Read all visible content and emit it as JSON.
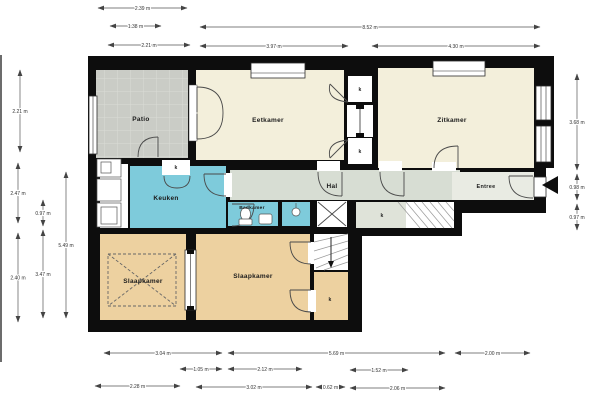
{
  "title": "floor-plan",
  "plan": {
    "colors": {
      "wall": "#0d0d0d",
      "living_cream": "#f3efdb",
      "kitchen_bath_teal": "#7ecbdb",
      "hall_gray": "#d7ddd3",
      "entree_gray": "#e9ebe3",
      "closet_gray": "#dfe3d9",
      "bedroom_tan": "#edd1a0",
      "patio_gray": "#caccc6",
      "dim_line": "#555555",
      "dim_text": "#333333"
    },
    "rooms": [
      {
        "id": "patio",
        "label": "Patio",
        "x": 96,
        "y": 70,
        "w": 92,
        "h": 88,
        "fill": "#caccc6",
        "pattern": "tiles",
        "lx": 141,
        "ly": 121,
        "fs": 6.5
      },
      {
        "id": "eetkamer",
        "label": "Eetkamer",
        "x": 196,
        "y": 70,
        "w": 148,
        "h": 90,
        "fill": "#f3efdb",
        "lx": 268,
        "ly": 122,
        "fs": 6.5
      },
      {
        "id": "zitkamer",
        "label": "Zitkamer",
        "x": 378,
        "y": 68,
        "w": 156,
        "h": 100,
        "fill": "#f3efdb",
        "lx": 452,
        "ly": 122,
        "fs": 6.5
      },
      {
        "id": "counter",
        "label": "",
        "x": 100,
        "y": 164,
        "w": 28,
        "h": 64,
        "fill": "#ffffff"
      },
      {
        "id": "keuken",
        "label": "Keuken",
        "x": 130,
        "y": 166,
        "w": 96,
        "h": 62,
        "fill": "#7ecbdb",
        "lx": 166,
        "ly": 200,
        "fs": 6.5
      },
      {
        "id": "hal",
        "label": "Hal",
        "x": 230,
        "y": 170,
        "w": 230,
        "h": 30,
        "fill": "#d7ddd3",
        "lx": 332,
        "ly": 188,
        "fs": 6.5
      },
      {
        "id": "badkamer",
        "label": "Badkamer",
        "x": 228,
        "y": 202,
        "w": 50,
        "h": 24,
        "fill": "#7ecbdb",
        "lx": 252,
        "ly": 209,
        "fs": 4.8
      },
      {
        "id": "douche",
        "label": "",
        "x": 282,
        "y": 202,
        "w": 28,
        "h": 24,
        "fill": "#7ecbdb"
      },
      {
        "id": "entree",
        "label": "Entree",
        "x": 452,
        "y": 172,
        "w": 82,
        "h": 28,
        "fill": "#e9ebe3",
        "lx": 486,
        "ly": 188,
        "fs": 5.5
      },
      {
        "id": "kastruimte",
        "label": "k",
        "x": 356,
        "y": 202,
        "w": 98,
        "h": 26,
        "fill": "#dfe3d9",
        "lx": 382,
        "ly": 217,
        "fs": 5
      },
      {
        "id": "slaapkamer-1",
        "label": "Slaapkamer",
        "x": 100,
        "y": 234,
        "w": 86,
        "h": 86,
        "fill": "#edd1a0",
        "lx": 143,
        "ly": 283,
        "fs": 6.5
      },
      {
        "id": "slaapkamer-2",
        "label": "Slaapkamer",
        "x": 196,
        "y": 234,
        "w": 114,
        "h": 86,
        "fill": "#edd1a0",
        "lx": 253,
        "ly": 278,
        "fs": 6.5
      },
      {
        "id": "trap",
        "label": "",
        "x": 314,
        "y": 234,
        "w": 34,
        "h": 36,
        "fill": "#ffffff"
      },
      {
        "id": "kast-onder",
        "label": "k",
        "x": 314,
        "y": 272,
        "w": 34,
        "h": 48,
        "fill": "#edd1a0",
        "lx": 330,
        "ly": 301,
        "fs": 5
      },
      {
        "id": "kast-boven-1",
        "label": "k",
        "x": 348,
        "y": 76,
        "w": 24,
        "h": 26,
        "fill": "#ffffff",
        "lx": 360,
        "ly": 91,
        "fs": 5
      },
      {
        "id": "kast-boven-2",
        "label": "k",
        "x": 348,
        "y": 138,
        "w": 24,
        "h": 26,
        "fill": "#ffffff",
        "lx": 360,
        "ly": 153,
        "fs": 5
      },
      {
        "id": "keuken-kast",
        "label": "k",
        "x": 162,
        "y": 160,
        "w": 28,
        "h": 15,
        "fill": "#ffffff",
        "lx": 176,
        "ly": 169,
        "fs": 5
      }
    ],
    "dimensions": {
      "top": [
        {
          "x1": 98,
          "x2": 187,
          "y": 8,
          "label": "2.39 m"
        },
        {
          "x1": 110,
          "x2": 161,
          "y": 26,
          "label": "1.38 m"
        },
        {
          "x1": 200,
          "x2": 540,
          "y": 27,
          "label": "8.52 m"
        },
        {
          "x1": 108,
          "x2": 190,
          "y": 45,
          "label": "2.21 m"
        },
        {
          "x1": 200,
          "x2": 348,
          "y": 46,
          "label": "3.97 m"
        },
        {
          "x1": 372,
          "x2": 540,
          "y": 46,
          "label": "4.30 m"
        }
      ],
      "left": [
        {
          "x": 20,
          "y1": 70,
          "y2": 152,
          "label": "2.21 m"
        },
        {
          "x": 18,
          "y1": 163,
          "y2": 223,
          "label": "2.47 m"
        },
        {
          "x": 18,
          "y1": 233,
          "y2": 322,
          "label": "2.40 m"
        },
        {
          "x": 43,
          "y1": 200,
          "y2": 226,
          "label": "0.97 m"
        },
        {
          "x": 43,
          "y1": 230,
          "y2": 318,
          "label": "3.47 m"
        },
        {
          "x": 66,
          "y1": 172,
          "y2": 318,
          "label": "5.49 m"
        }
      ],
      "right": [
        {
          "x": 577,
          "y1": 74,
          "y2": 170,
          "label": "3.68 m"
        },
        {
          "x": 577,
          "y1": 174,
          "y2": 200,
          "label": "0.98 m"
        },
        {
          "x": 577,
          "y1": 204,
          "y2": 230,
          "label": "0.97 m"
        }
      ],
      "bottom": [
        {
          "x1": 104,
          "x2": 222,
          "y": 353,
          "label": "3.04 m"
        },
        {
          "x1": 228,
          "x2": 445,
          "y": 353,
          "label": "5.69 m"
        },
        {
          "x1": 455,
          "x2": 530,
          "y": 353,
          "label": "2.00 m"
        },
        {
          "x1": 180,
          "x2": 222,
          "y": 369,
          "label": "1.05 m"
        },
        {
          "x1": 228,
          "x2": 302,
          "y": 369,
          "label": "2.12 m"
        },
        {
          "x1": 350,
          "x2": 408,
          "y": 370,
          "label": "1.52 m"
        },
        {
          "x1": 95,
          "x2": 180,
          "y": 386,
          "label": "2.28 m"
        },
        {
          "x1": 196,
          "x2": 312,
          "y": 387,
          "label": "3.02 m"
        },
        {
          "x1": 316,
          "x2": 345,
          "y": 387,
          "label": "0.62 m"
        },
        {
          "x1": 350,
          "x2": 445,
          "y": 388,
          "label": "2.06 m"
        }
      ]
    }
  }
}
